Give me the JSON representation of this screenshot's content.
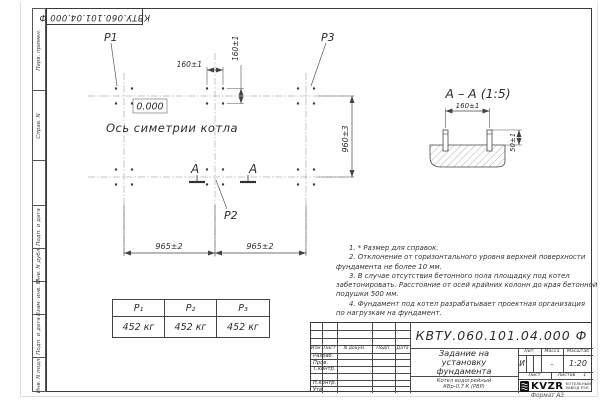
{
  "sheet": {
    "designation_stamp": "КВТУ.060.101.04.000  Ф",
    "format_label": "Формат А3",
    "side_labels": [
      "Перв. примен.",
      "Справ. N",
      "Подп. и дата",
      "Инв. N дубл.",
      "Взам. инв. N",
      "Подп. и дата",
      "Инв. N подл."
    ]
  },
  "plan": {
    "label_p1": "P1",
    "label_p2": "P2",
    "label_p3": "P3",
    "dim_group_h": "160±1",
    "dim_group_v": "160±1",
    "dim_row_span": "960±3",
    "dim_col_left": "965±2",
    "dim_col_right": "965±2",
    "zero_level": "0.000",
    "axis_caption": "Ось симетрии котла",
    "section_mark": "А"
  },
  "section_view": {
    "title": "А – А (1:5)",
    "dim_bolts": "160±1",
    "dim_height": "50±1"
  },
  "notes": {
    "lines": [
      "1. * Размер для справок.",
      "2. Отклонение от горизонтального уровня верхней поверхности",
      "фундамента не более 10 мм.",
      "3. В случае отсутствия бетонного пола площадку под котел",
      "забетонировать. Расстояние от осей крайних колонн до края бетонной",
      "подушки 500 мм.",
      "4. Фундамент под котел разрабатывает проектная организация",
      "по нагрузкам на фундамент."
    ]
  },
  "load_table": {
    "headers": [
      "P₁",
      "P₂",
      "P₃"
    ],
    "values": [
      "452 кг",
      "452 кг",
      "452 кг"
    ]
  },
  "title_block": {
    "designation": "КВТУ.060.101.04.000  Ф",
    "doc_title_lines": [
      "Задание на",
      "установку",
      "фундамента"
    ],
    "product_lines": [
      "Котел водогрейный",
      "КВр-0,7 К  (РВР)"
    ],
    "revision_headers": [
      "Изм.",
      "Лист",
      "N докум.",
      "Подп.",
      "Дата"
    ],
    "signature_rows": [
      "Разраб.",
      "Пров.",
      "Т.контр.",
      "",
      "Н.контр.",
      "Утв."
    ],
    "lit_label": "Лит.",
    "mass_label": "Масса",
    "scale_label": "Масштаб",
    "lit_value": "И",
    "mass_value": "–",
    "scale_value": "1:20",
    "sheet_label": "Лист",
    "sheets_label": "Листов",
    "sheets_value": "1",
    "logo_text": "KVZR",
    "logo_caption_lines": [
      "КОТЕЛЬНЫЙ",
      "ЗАВОД РЭП"
    ]
  }
}
